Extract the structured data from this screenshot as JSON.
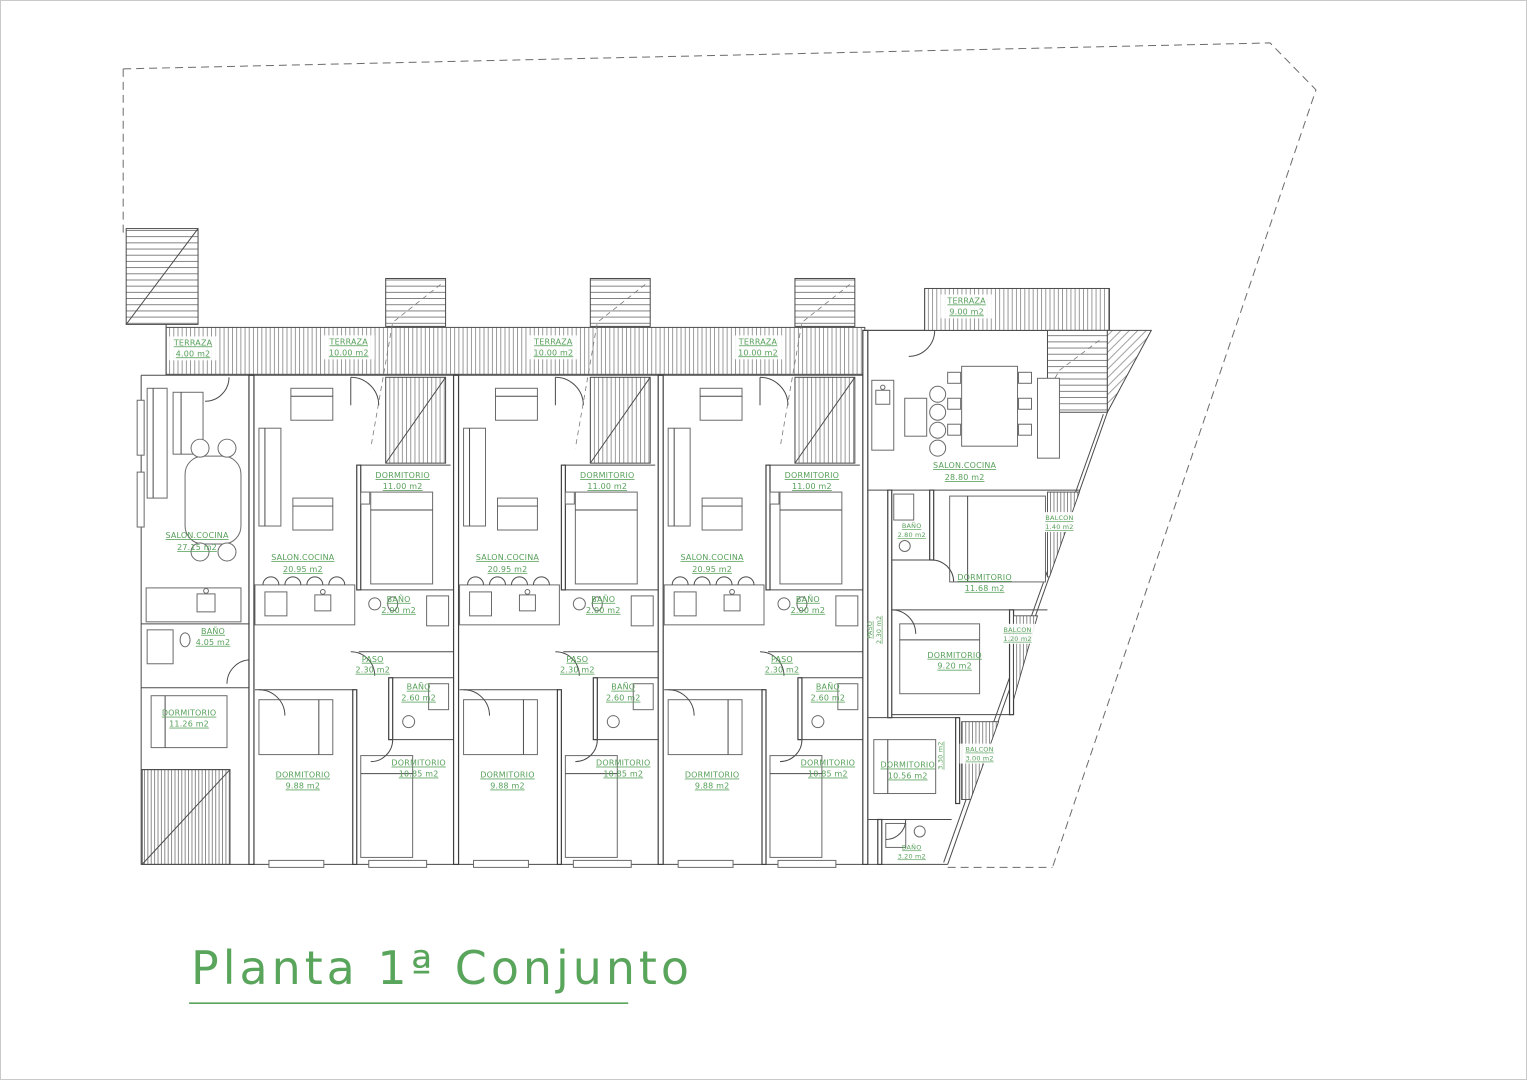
{
  "title": {
    "text": "Planta 1ª Conjunto"
  },
  "colors": {
    "ink": "#3f3f3f",
    "label_green": "#57a05a",
    "hatch": "#9a9a9a",
    "background": "#ffffff"
  },
  "unit_left": {
    "terraza": {
      "name": "TERRAZA",
      "area": "4.00 m2"
    },
    "salon": {
      "name": "SALON.COCINA",
      "area": "27.15 m2"
    },
    "bano": {
      "name": "BAÑO",
      "area": "4.05 m2"
    },
    "dormitorio": {
      "name": "DORMITORIO",
      "area": "11.26 m2"
    }
  },
  "units": [
    {
      "terraza": {
        "name": "TERRAZA",
        "area": "10.00 m2"
      },
      "salon": {
        "name": "SALON.COCINA",
        "area": "20.95 m2"
      },
      "dormitorio1": {
        "name": "DORMITORIO",
        "area": "11.00 m2"
      },
      "bano1": {
        "name": "BAÑO",
        "area": "2.00 m2"
      },
      "paso": {
        "name": "PASO",
        "area": "2.30 m2"
      },
      "bano2": {
        "name": "BAÑO",
        "area": "2.60 m2"
      },
      "dormitorio2": {
        "name": "DORMITORIO",
        "area": "9.88 m2"
      },
      "dormitorio3": {
        "name": "DORMITORIO",
        "area": "10.85 m2"
      }
    },
    {
      "terraza": {
        "name": "TERRAZA",
        "area": "10.00 m2"
      },
      "salon": {
        "name": "SALON.COCINA",
        "area": "20.95 m2"
      },
      "dormitorio1": {
        "name": "DORMITORIO",
        "area": "11.00 m2"
      },
      "bano1": {
        "name": "BAÑO",
        "area": "2.00 m2"
      },
      "paso": {
        "name": "PASO",
        "area": "2.30 m2"
      },
      "bano2": {
        "name": "BAÑO",
        "area": "2.60 m2"
      },
      "dormitorio2": {
        "name": "DORMITORIO",
        "area": "9.88 m2"
      },
      "dormitorio3": {
        "name": "DORMITORIO",
        "area": "10.85 m2"
      }
    },
    {
      "terraza": {
        "name": "TERRAZA",
        "area": "10.00 m2"
      },
      "salon": {
        "name": "SALON.COCINA",
        "area": "20.95 m2"
      },
      "dormitorio1": {
        "name": "DORMITORIO",
        "area": "11.00 m2"
      },
      "bano1": {
        "name": "BAÑO",
        "area": "2.00 m2"
      },
      "paso": {
        "name": "PASO",
        "area": "2.30 m2"
      },
      "bano2": {
        "name": "BAÑO",
        "area": "2.60 m2"
      },
      "dormitorio2": {
        "name": "DORMITORIO",
        "area": "9.88 m2"
      },
      "dormitorio3": {
        "name": "DORMITORIO",
        "area": "10.85 m2"
      }
    }
  ],
  "right_unit": {
    "terraza": {
      "name": "TERRAZA",
      "area": "9.00 m2"
    },
    "paso": {
      "name": "PASO",
      "area": "2.30 m2"
    },
    "salon": {
      "name": "SALON.COCINA",
      "area": "28.80 m2"
    },
    "bano1": {
      "name": "BAÑO",
      "area": "2.80 m2"
    },
    "dormitorio1": {
      "name": "DORMITORIO",
      "area": "11.68 m2"
    },
    "balcon1": {
      "name": "BALCON",
      "area": "1.40 m2"
    },
    "dormitorio2": {
      "name": "DORMITORIO",
      "area": "9.20 m2"
    },
    "balcon2": {
      "name": "BALCON",
      "area": "1.20 m2"
    },
    "pasillo": {
      "name": "PASILLO",
      "area": "3.30 m2"
    },
    "dormitorio3": {
      "name": "DORMITORIO",
      "area": "10.56 m2"
    },
    "balcon3": {
      "name": "BALCON",
      "area": "3.00 m2"
    },
    "bano2": {
      "name": "BAÑO",
      "area": "3.20 m2"
    }
  }
}
